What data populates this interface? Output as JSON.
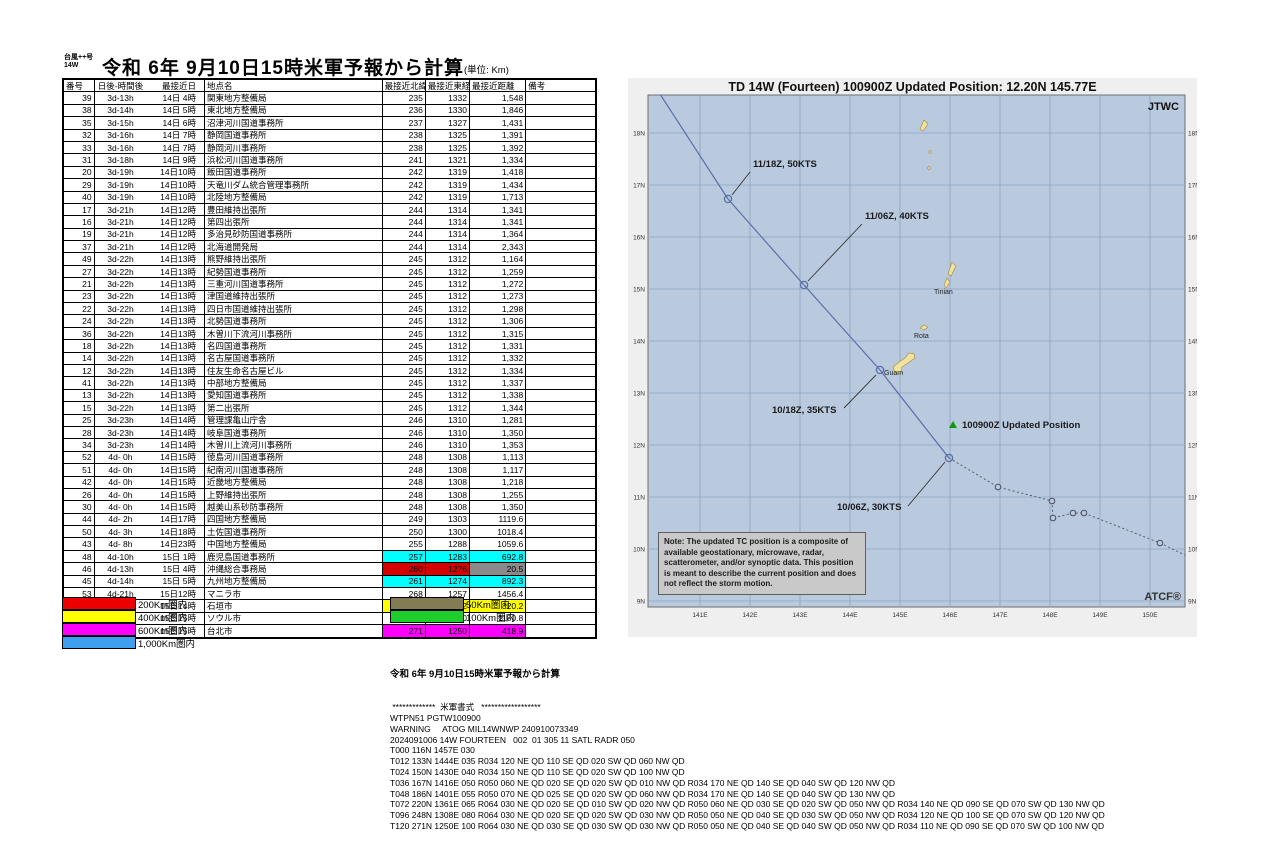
{
  "header": {
    "storm_label_line1": "台風++号",
    "storm_label_line2": "14W",
    "title": "令和 6年 9月10日15時米軍予報から計算",
    "unit": "(単位: Km)"
  },
  "table": {
    "columns": [
      "番号",
      "日後-時間後",
      "最接近日",
      "地点名",
      "最接近北緯",
      "最接近東経",
      "最接近距離",
      "備考"
    ],
    "hl_colors": {
      "cyan": "#00ffff",
      "red": "#d60000",
      "gray": "#8a8a8a",
      "yellow": "#ffff00",
      "magenta": "#ff00ff"
    },
    "rows": [
      [
        "39",
        "3d-13h",
        "14日 4時",
        "関東地方整備局",
        "235",
        "1332",
        "1,548",
        null
      ],
      [
        "38",
        "3d-14h",
        "14日 5時",
        "東北地方整備局",
        "236",
        "1330",
        "1,846",
        null
      ],
      [
        "35",
        "3d-15h",
        "14日 6時",
        "沼津河川国道事務所",
        "237",
        "1327",
        "1,431",
        null
      ],
      [
        "32",
        "3d-16h",
        "14日 7時",
        "静岡国道事務所",
        "238",
        "1325",
        "1,391",
        null
      ],
      [
        "33",
        "3d-16h",
        "14日 7時",
        "静岡河川事務所",
        "238",
        "1325",
        "1,392",
        null
      ],
      [
        "31",
        "3d-18h",
        "14日 9時",
        "浜松河川国道事務所",
        "241",
        "1321",
        "1,334",
        null
      ],
      [
        "20",
        "3d-19h",
        "14日10時",
        "飯田国道事務所",
        "242",
        "1319",
        "1,418",
        null
      ],
      [
        "29",
        "3d-19h",
        "14日10時",
        "天竜川ダム統合管理事務所",
        "242",
        "1319",
        "1,434",
        null
      ],
      [
        "40",
        "3d-19h",
        "14日10時",
        "北陸地方整備局",
        "242",
        "1319",
        "1,713",
        null
      ],
      [
        "17",
        "3d-21h",
        "14日12時",
        "豊田維持出張所",
        "244",
        "1314",
        "1,341",
        null
      ],
      [
        "16",
        "3d-21h",
        "14日12時",
        "第四出張所",
        "244",
        "1314",
        "1,341",
        null
      ],
      [
        "19",
        "3d-21h",
        "14日12時",
        "多治見砂防国道事務所",
        "244",
        "1314",
        "1,364",
        null
      ],
      [
        "37",
        "3d-21h",
        "14日12時",
        "北海道開発局",
        "244",
        "1314",
        "2,343",
        null
      ],
      [
        "49",
        "3d-22h",
        "14日13時",
        "熊野維持出張所",
        "245",
        "1312",
        "1,164",
        null
      ],
      [
        "27",
        "3d-22h",
        "14日13時",
        "紀勢国道事務所",
        "245",
        "1312",
        "1,259",
        null
      ],
      [
        "21",
        "3d-22h",
        "14日13時",
        "三重河川国道事務所",
        "245",
        "1312",
        "1,272",
        null
      ],
      [
        "23",
        "3d-22h",
        "14日13時",
        "津国道維持出張所",
        "245",
        "1312",
        "1,273",
        null
      ],
      [
        "22",
        "3d-22h",
        "14日13時",
        "四日市国道維持出張所",
        "245",
        "1312",
        "1,298",
        null
      ],
      [
        "24",
        "3d-22h",
        "14日13時",
        "北勢国道事務所",
        "245",
        "1312",
        "1,306",
        null
      ],
      [
        "36",
        "3d-22h",
        "14日13時",
        "木曽川下流河川事務所",
        "245",
        "1312",
        "1,315",
        null
      ],
      [
        "18",
        "3d-22h",
        "14日13時",
        "名四国道事務所",
        "245",
        "1312",
        "1,331",
        null
      ],
      [
        "14",
        "3d-22h",
        "14日13時",
        "名古屋国道事務所",
        "245",
        "1312",
        "1,332",
        null
      ],
      [
        "12",
        "3d-22h",
        "14日13時",
        "住友生命名古屋ビル",
        "245",
        "1312",
        "1,334",
        null
      ],
      [
        "41",
        "3d-22h",
        "14日13時",
        "中部地方整備局",
        "245",
        "1312",
        "1,337",
        null
      ],
      [
        "13",
        "3d-22h",
        "14日13時",
        "愛知国道事務所",
        "245",
        "1312",
        "1,338",
        null
      ],
      [
        "15",
        "3d-22h",
        "14日13時",
        "第二出張所",
        "245",
        "1312",
        "1,344",
        null
      ],
      [
        "25",
        "3d-23h",
        "14日14時",
        "管理課亀山庁舎",
        "246",
        "1310",
        "1,281",
        null
      ],
      [
        "28",
        "3d-23h",
        "14日14時",
        "岐阜国道事務所",
        "246",
        "1310",
        "1,350",
        null
      ],
      [
        "34",
        "3d-23h",
        "14日14時",
        "木曽川上流河川事務所",
        "246",
        "1310",
        "1,353",
        null
      ],
      [
        "52",
        "4d- 0h",
        "14日15時",
        "徳島河川国道事務所",
        "248",
        "1308",
        "1,113",
        null
      ],
      [
        "51",
        "4d- 0h",
        "14日15時",
        "紀南河川国道事務所",
        "248",
        "1308",
        "1,117",
        null
      ],
      [
        "42",
        "4d- 0h",
        "14日15時",
        "近畿地方整備局",
        "248",
        "1308",
        "1,218",
        null
      ],
      [
        "26",
        "4d- 0h",
        "14日15時",
        "上野維持出張所",
        "248",
        "1308",
        "1,255",
        null
      ],
      [
        "30",
        "4d- 0h",
        "14日15時",
        "越美山系砂防事務所",
        "248",
        "1308",
        "1,350",
        null
      ],
      [
        "44",
        "4d- 2h",
        "14日17時",
        "四国地方整備局",
        "249",
        "1303",
        "1119.6",
        null
      ],
      [
        "50",
        "4d- 3h",
        "14日18時",
        "土佐国道事務所",
        "250",
        "1300",
        "1018.4",
        null
      ],
      [
        "43",
        "4d- 8h",
        "14日23時",
        "中国地方整備局",
        "255",
        "1288",
        "1059.6",
        null
      ],
      [
        "48",
        "4d-10h",
        "15日 1時",
        "鹿児島国道事務所",
        "257",
        "1283",
        "692.8",
        [
          "cyan",
          "cyan",
          "cyan"
        ]
      ],
      [
        "46",
        "4d-13h",
        "15日 4時",
        "沖縄総合事務局",
        "260",
        "1276",
        "20.5",
        [
          "red",
          "red",
          "gray"
        ]
      ],
      [
        "45",
        "4d-14h",
        "15日 5時",
        "九州地方整備局",
        "261",
        "1274",
        "892.3",
        [
          "cyan",
          "cyan",
          "cyan"
        ]
      ],
      [
        "53",
        "4d-21h",
        "15日12時",
        "マニラ市",
        "268",
        "1257",
        "1456.4",
        null
      ],
      [
        "54",
        "4d-23h",
        "15日14時",
        "石垣市",
        "270",
        "1252",
        "320.2",
        [
          "yellow",
          "yellow",
          "yellow"
        ]
      ],
      [
        "55",
        "5d- 0h",
        "15日15時",
        "ソウル市",
        "271",
        "1250",
        "1180.8",
        null
      ],
      [
        "47",
        "5d- 0h",
        "15日15時",
        "台北市",
        "271",
        "1250",
        "418.9",
        [
          "magenta",
          "magenta",
          "magenta"
        ]
      ]
    ]
  },
  "legend": {
    "left": [
      {
        "color": "#ee0000",
        "label": "200Km圏内"
      },
      {
        "color": "#ffff00",
        "label": "400Km圏内"
      },
      {
        "color": "#ff00ff",
        "label": "600Km圏内"
      },
      {
        "color": "#3f9fef",
        "label": "1,000Km圏内"
      }
    ],
    "right": [
      {
        "color": "#837b54",
        "label": "50Km圏内"
      },
      {
        "color": "#1fce2c",
        "label": "100Km圏内"
      }
    ]
  },
  "map": {
    "title": "TD 14W (Fourteen) 100900Z Updated Position: 12.20N 145.77E",
    "agency": "JTWC",
    "watermark": "ATCF®",
    "lat_labels": [
      "18N",
      "17N",
      "16N",
      "15N",
      "14N",
      "13N",
      "12N",
      "11N",
      "10N",
      "9N"
    ],
    "lon_labels": [
      "141E",
      "142E",
      "143E",
      "144E",
      "145E",
      "146E",
      "147E",
      "148E",
      "149E",
      "150E"
    ],
    "islands": [
      "Guam",
      "Rota",
      "Tinian"
    ],
    "note": "Note:  The updated TC position is a composite of available geostationary, microwave, radar, scatterometer, and/or synoptic data.   This position is meant to describe the current position and does not reflect the storm motion.",
    "track": {
      "updated_position_label": "100900Z Updated Position",
      "updated_position": "12.20N 145.77E",
      "forecast_points": [
        {
          "label": "10/06Z, 30KTS",
          "lat": "11.6N",
          "lon": "145.7E"
        },
        {
          "label": "10/18Z, 35KTS",
          "lat": "13.3N",
          "lon": "144.4E"
        },
        {
          "label": "11/06Z, 40KTS",
          "lat": "15.0N",
          "lon": "143.0E"
        },
        {
          "label": "11/18Z, 50KTS",
          "lat": "16.7N",
          "lon": "141.6E"
        }
      ]
    }
  },
  "warning_block": {
    "title": "令和 6年 9月10日15時米軍予報から計算",
    "lines": [
      " *************  米軍書式   ******************",
      "WTPN51 PGTW100900",
      "WARNING     ATOG MIL14WNWP 240910073349",
      "2024091006 14W FOURTEEN   002  01 305 11 SATL RADR 050",
      "T000 116N 1457E 030",
      "T012 133N 1444E 035 R034 120 NE QD 110 SE QD 020 SW QD 060 NW QD",
      "T024 150N 1430E 040 R034 150 NE QD 110 SE QD 020 SW QD 100 NW QD",
      "T036 167N 1416E 050 R050 060 NE QD 020 SE QD 020 SW QD 010 NW QD R034 170 NE QD 140 SE QD 040 SW QD 120 NW QD",
      "T048 186N 1401E 055 R050 070 NE QD 025 SE QD 020 SW QD 060 NW QD R034 170 NE QD 140 SE QD 040 SW QD 130 NW QD",
      "T072 220N 1361E 065 R064 030 NE QD 020 SE QD 010 SW QD 020 NW QD R050 060 NE QD 030 SE QD 020 SW QD 050 NW QD R034 140 NE QD 090 SE QD 070 SW QD 130 NW QD",
      "T096 248N 1308E 080 R064 030 NE QD 020 SE QD 020 SW QD 030 NW QD R050 050 NE QD 040 SE QD 030 SW QD 050 NW QD R034 120 NE QD 100 SE QD 070 SW QD 120 NW QD",
      "T120 271N 1250E 100 R064 030 NE QD 030 SE QD 030 SW QD 030 NW QD R050 050 NE QD 040 SE QD 040 SW QD 050 NW QD R034 110 NE QD 090 SE QD 070 SW QD 100 NW QD"
    ]
  }
}
